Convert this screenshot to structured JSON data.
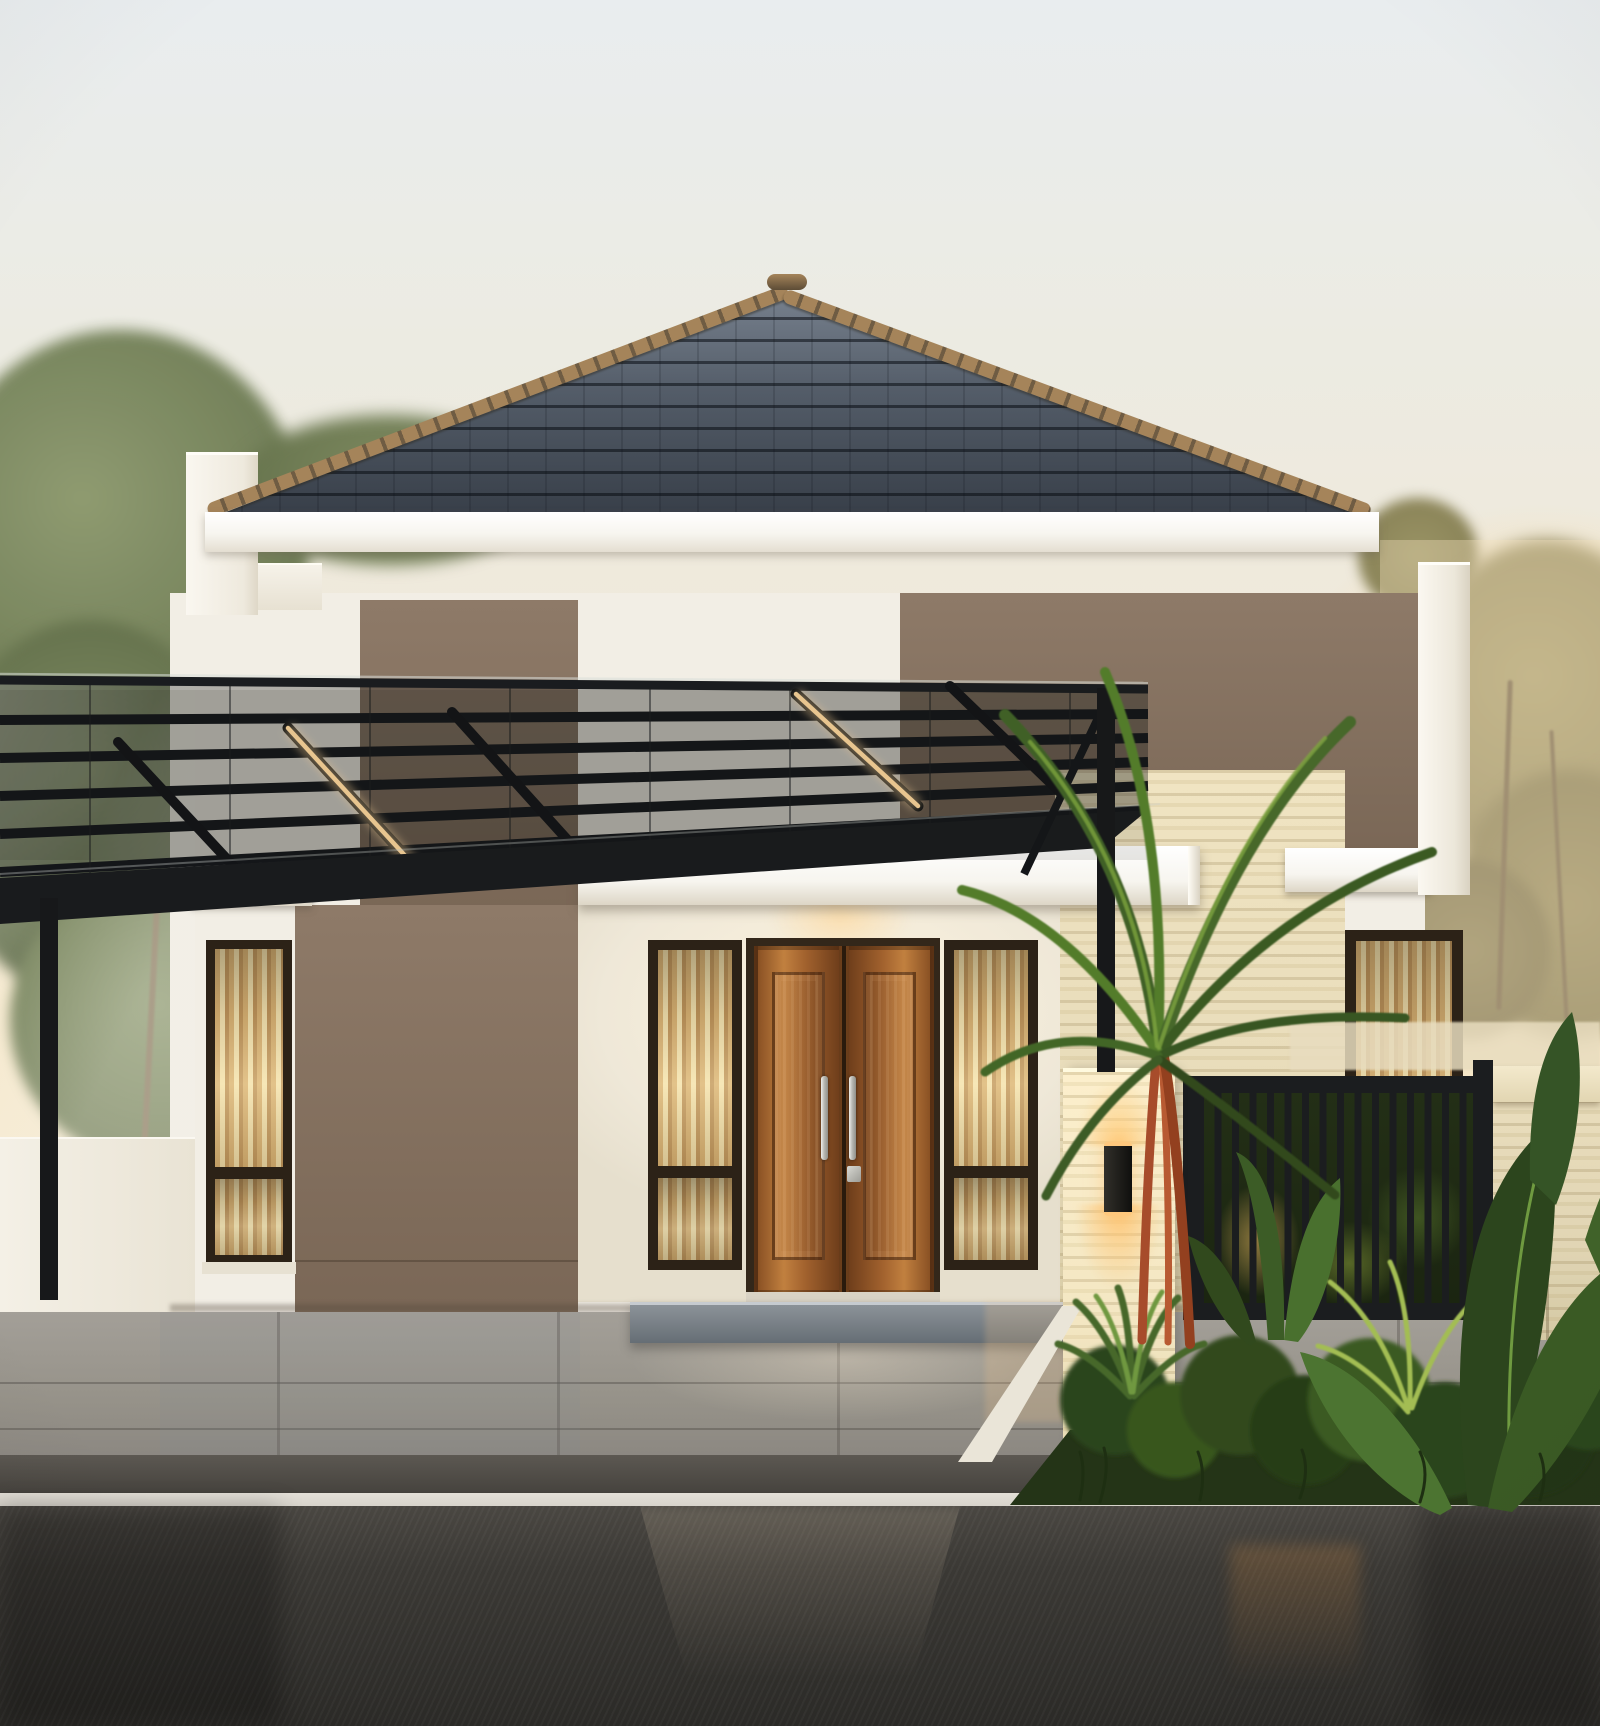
{
  "meta": {
    "title": "Modern minimalist single-story house exterior at dusk",
    "type": "architectural-photo-render",
    "width_px": 1600,
    "height_px": 1726
  },
  "scene": {
    "setting": "front elevation of a modern tropical minimalist house after rain at golden hour",
    "elements": [
      "dark hipped clay-tile roof with tan ridge caps",
      "white stucco facade with taupe accent panels",
      "black steel carport canopy with glass top and warm LED strip lights",
      "left carport glass side wall with trees behind",
      "wooden double entry door with long stainless pull handles and keypad lock",
      "sidelight windows with warm lit curtains",
      "tall narrow window on left wing with warm lit curtain",
      "travertine stone feature wall and pillar",
      "black cylindrical up-down wall sconce, lit",
      "recessed porch downlight, lit",
      "black vertical-slat metal gate and fence post",
      "travertine perimeter fence",
      "lipstick palm with red stems and tropical planting bed",
      "banana-leaf plants and low shrubs",
      "grey stone tile driveway and porch step",
      "white curb strip and dark wet asphalt road with reflections",
      "hazy background trees, pale dusk sky"
    ]
  },
  "palette": {
    "sky-top": "#e9edef",
    "sky-mid": "#f0e9da",
    "sky-warm": "#f6e9cd",
    "roof-top": "#7d8794",
    "roof-mid": "#535c68",
    "roof-dark": "#373e48",
    "ridge": "#a5845a",
    "ridge-dark": "#6f5c43",
    "fascia": "#f7f5ef",
    "white-wall": "#f2eee5",
    "taupe": "#8e7a68",
    "taupe-dark": "#7a6756",
    "travertine": "#e8dcba",
    "trav-warm": "#f0e4c2",
    "black-steel": "#1b1d1f",
    "wood": "#a2622e",
    "wood-dark": "#6f3e1b",
    "wood-light": "#c1803f",
    "frame-dark": "#2c2217",
    "curtain-a": "#d9b273",
    "curtain-b": "#f4e3b0",
    "led": "#ffd99e",
    "lamp": "#ffc87d",
    "step-dark": "#666e75",
    "drive-tile": "#a39f98",
    "drive-dark": "#8b8781",
    "curb": "#d8d4cc",
    "road": "#3b3935",
    "road-dark": "#2b2a27",
    "leaf-dark": "#2d461f",
    "leaf": "#46682c",
    "leaf-light": "#6f9840",
    "leaf-bright": "#a3bd52",
    "palm-stem": "#a74c2b",
    "tree-olive": "#7b865f",
    "tree-gold": "#a79c6d"
  }
}
